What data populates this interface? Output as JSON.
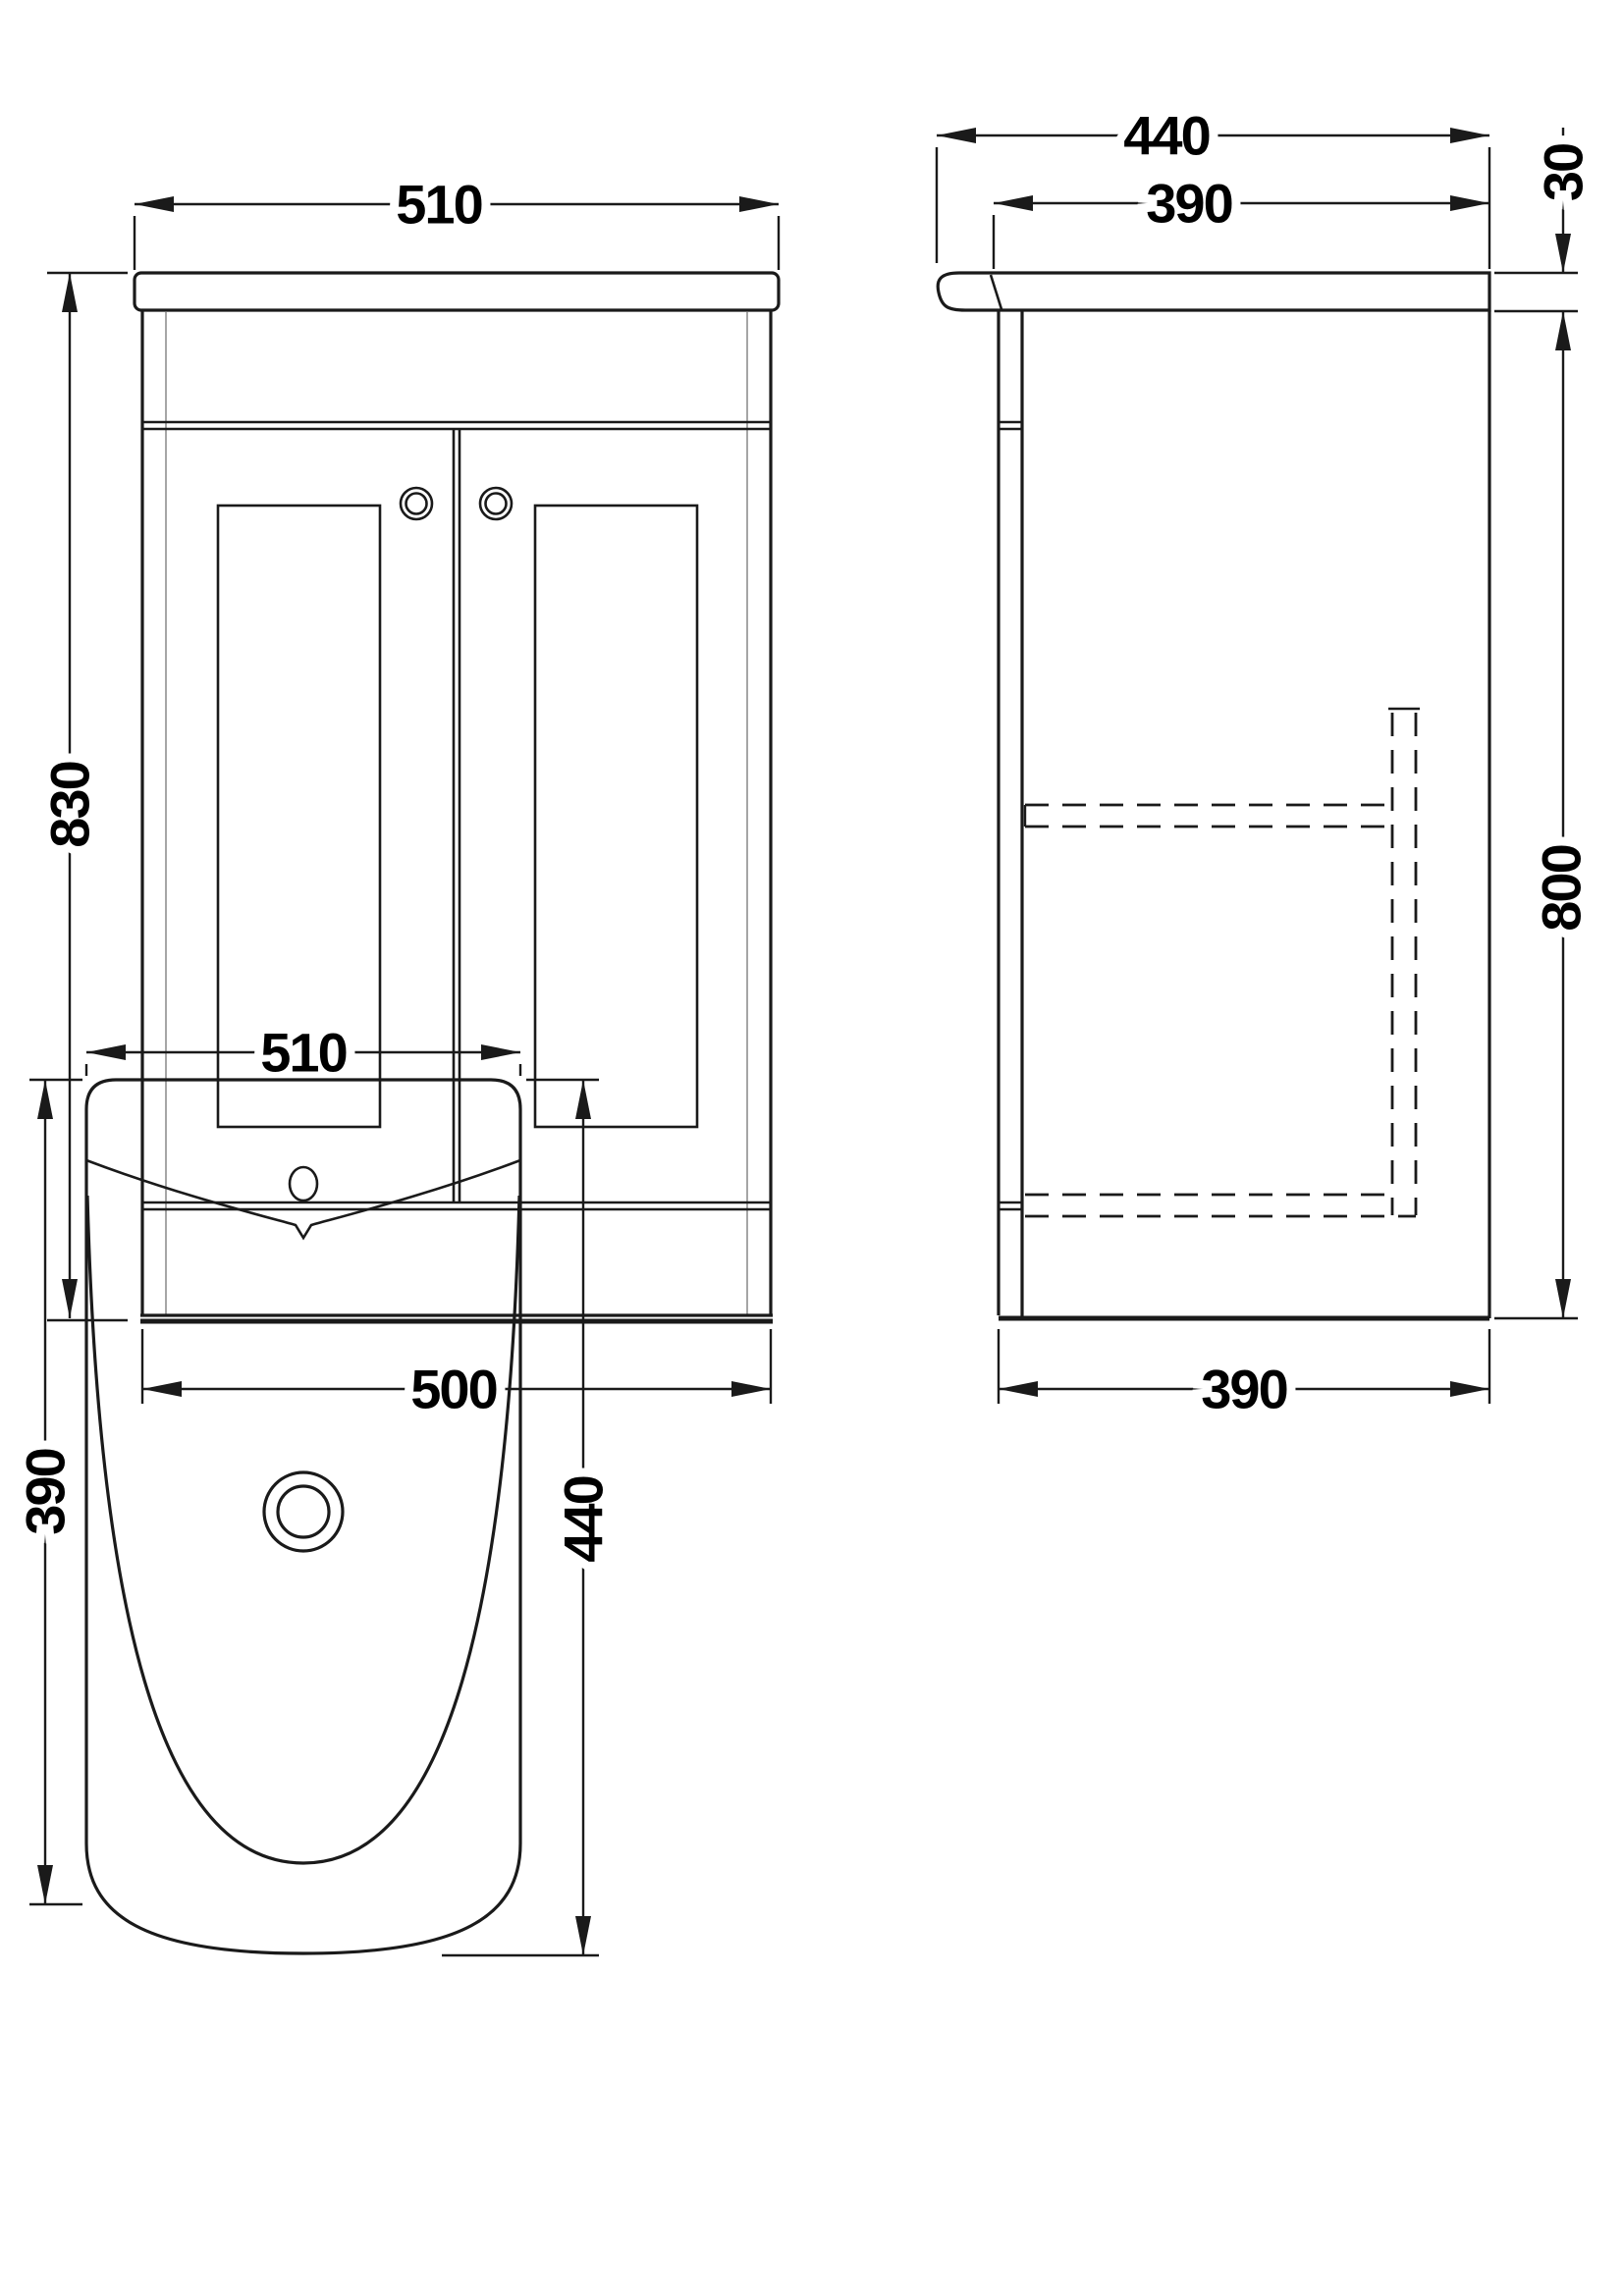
{
  "drawing": {
    "front_view": {
      "width_top": "510",
      "height": "830",
      "width_bottom": "500"
    },
    "side_view": {
      "depth_top": "440",
      "depth_body": "390",
      "counter_thickness": "30",
      "body_height": "800",
      "depth_bottom": "390"
    },
    "plan_view": {
      "width": "510",
      "depth_left": "390",
      "depth_right": "440"
    }
  },
  "colors": {
    "line": "#1a1a1a",
    "light_line": "#a6a6a6",
    "background": "#ffffff"
  }
}
